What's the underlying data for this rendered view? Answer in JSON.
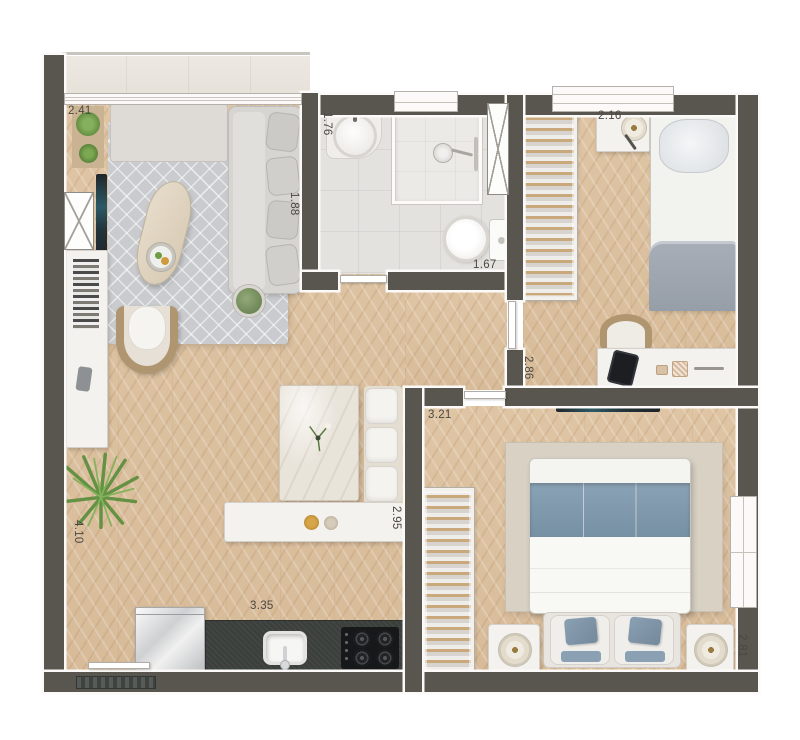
{
  "plan": {
    "type": "apartment-floor-plan-top-view",
    "dimensions": {
      "balcony": "2.41",
      "bath_width": "1.76",
      "bath_length": "1.67",
      "bedroom1_head": "2.16",
      "bedroom1_depth": "2.86",
      "living_sofa": "1.88",
      "living_length": "4.10",
      "master_width": "3.21",
      "master_depth": "2.81",
      "island": "2.95",
      "kitchen": "3.35"
    },
    "colors": {
      "wall": "#59554f",
      "wood_floor": "#dbc09e",
      "rug": "#c9cbce",
      "accent_blue": "#8098ac",
      "kitchen_counter": "#3b403d",
      "label_text": "#4b4742"
    },
    "icons": {
      "sofa": "sofa-top-view",
      "bed": "bed-top-view",
      "wardrobe": "open-closet-hangers",
      "shaft": "crossed-box-shaft",
      "door": "door-leaf",
      "window": "window-frame"
    }
  }
}
